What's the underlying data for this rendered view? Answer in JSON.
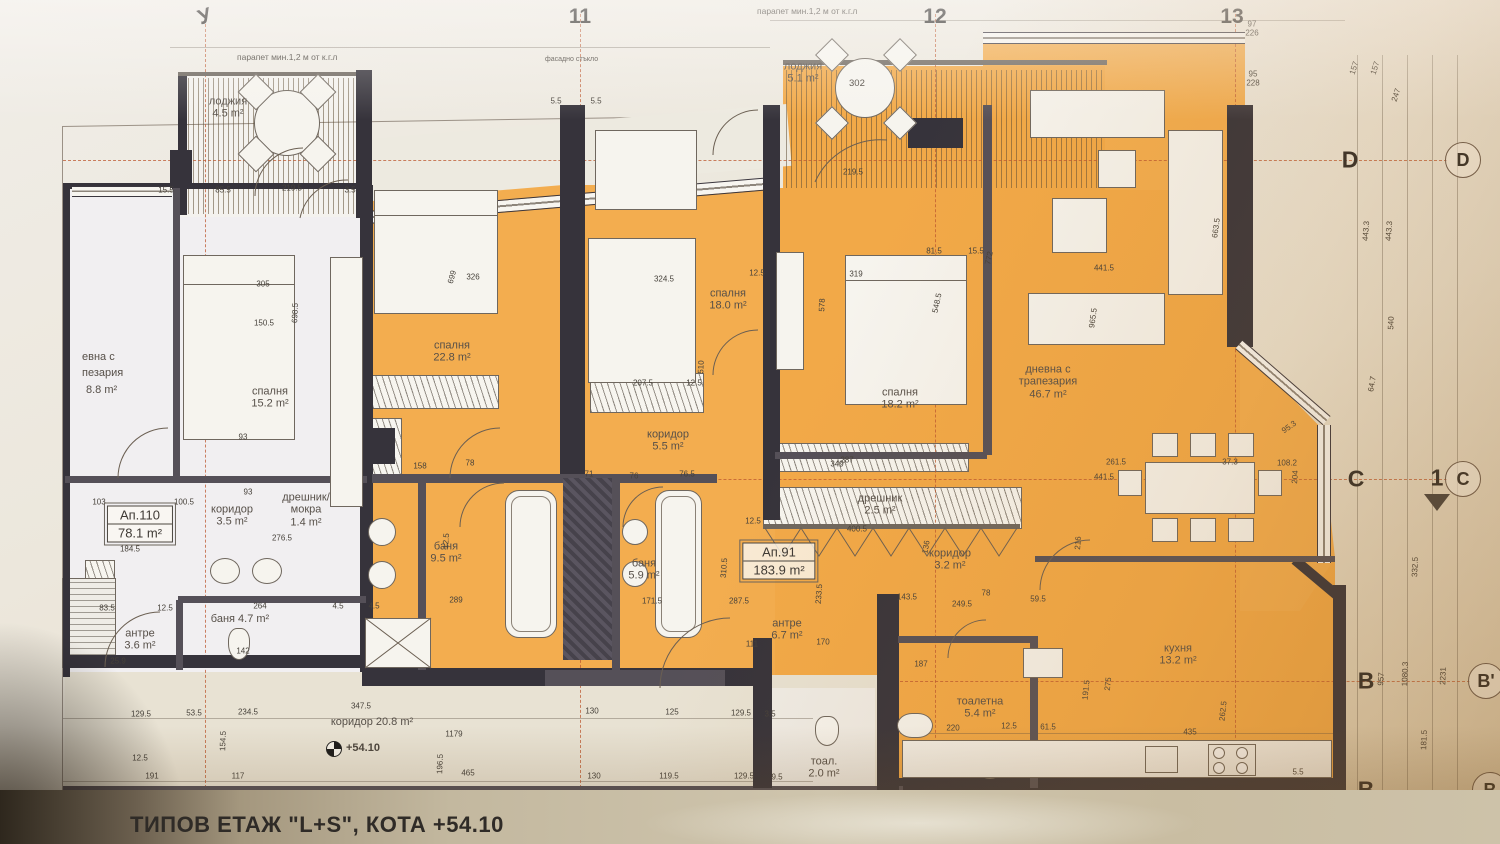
{
  "meta": {
    "title_block": "ТИПОВ ЕТАЖ \"L+S\", КОТА +54.10"
  },
  "annotations": {
    "parapet_left": "парапет мин.1,2 м от к.г.л",
    "parapet_top": "парапет мин.1,2 м от к.г.л",
    "facade_glass": "фасадно стъкло",
    "level_mark": "+54.10",
    "loggia_room_number": "302"
  },
  "apartment_tags": [
    {
      "id": "Ап.110",
      "area": "78.1 m²",
      "x": 140,
      "y": 524
    },
    {
      "id": "Ап.91",
      "area": "183.9 m²",
      "x": 779,
      "y": 561
    }
  ],
  "rooms": [
    {
      "lines": [
        "лоджия",
        "4.5 m²"
      ],
      "x": 228,
      "y": 108
    },
    {
      "lines": [
        "лоджия",
        "5.1 m²"
      ],
      "x": 803,
      "y": 73
    },
    {
      "lines": [
        "спалня",
        "15.2 m²"
      ],
      "x": 270,
      "y": 398
    },
    {
      "lines": [
        "спалня",
        "22.8 m²"
      ],
      "x": 452,
      "y": 352
    },
    {
      "lines": [
        "спалня",
        "18.0 m²"
      ],
      "x": 728,
      "y": 300
    },
    {
      "lines": [
        "спалня",
        "18.2 m²"
      ],
      "x": 900,
      "y": 399
    },
    {
      "lines": [
        "дневна с",
        "трапезария",
        "46.7 m²"
      ],
      "x": 1048,
      "y": 382
    },
    {
      "lines": [
        "коридор",
        "5.5 m²"
      ],
      "x": 668,
      "y": 441
    },
    {
      "lines": [
        "коридор",
        "3.5 m²"
      ],
      "x": 232,
      "y": 516
    },
    {
      "lines": [
        "коридор",
        "3.2 m²"
      ],
      "x": 950,
      "y": 560
    },
    {
      "lines": [
        "баня",
        "9.5 m²"
      ],
      "x": 446,
      "y": 553
    },
    {
      "lines": [
        "баня",
        "5.9 m²"
      ],
      "x": 644,
      "y": 570
    },
    {
      "lines": [
        "баня 4.7 m²"
      ],
      "x": 240,
      "y": 619
    },
    {
      "lines": [
        "антре",
        "3.6 m²"
      ],
      "x": 140,
      "y": 640
    },
    {
      "lines": [
        "антре",
        "6.7 m²"
      ],
      "x": 787,
      "y": 630
    },
    {
      "lines": [
        "дрешник/",
        "мокра",
        "1.4 m²"
      ],
      "x": 306,
      "y": 510
    },
    {
      "lines": [
        "дрешник",
        "2.5 m²"
      ],
      "x": 880,
      "y": 505
    },
    {
      "lines": [
        "тоалетна",
        "5.4 m²"
      ],
      "x": 980,
      "y": 708
    },
    {
      "lines": [
        "тоал.",
        "2.0 m²"
      ],
      "x": 824,
      "y": 768
    },
    {
      "lines": [
        "кухня",
        "13.2 m²"
      ],
      "x": 1178,
      "y": 655
    },
    {
      "lines": [
        "коридор 20.8 m²"
      ],
      "x": 372,
      "y": 722
    }
  ],
  "partial_labels": [
    {
      "t": "евна с",
      "x": 82,
      "y": 357
    },
    {
      "t": "пезария",
      "x": 82,
      "y": 373
    },
    {
      "t": "8.8 m²",
      "x": 86,
      "y": 390
    }
  ],
  "grid": {
    "top": [
      {
        "label": "У",
        "x": 205,
        "r": -18
      },
      {
        "label": "11",
        "x": 580,
        "r": 0
      },
      {
        "label": "12",
        "x": 935,
        "r": 0
      },
      {
        "label": "13",
        "x": 1232,
        "r": 0
      }
    ],
    "right_letters": [
      {
        "label": "D",
        "x": 1350,
        "y": 160
      },
      {
        "label": "C",
        "x": 1356,
        "y": 479
      },
      {
        "label": "B",
        "x": 1366,
        "y": 681
      },
      {
        "label": "B",
        "x": 1366,
        "y": 790
      }
    ],
    "right_bubbles": [
      {
        "label": "D",
        "x": 1463,
        "y": 160
      },
      {
        "label": "C",
        "x": 1463,
        "y": 479
      },
      {
        "label": "B'",
        "x": 1486,
        "y": 681
      },
      {
        "label": "B",
        "x": 1490,
        "y": 790
      }
    ],
    "section_mark": {
      "label": "1",
      "x": 1437,
      "y": 478
    }
  },
  "dims": [
    {
      "t": "15.5",
      "x": 166,
      "y": 190
    },
    {
      "t": "85.5",
      "x": 223,
      "y": 190
    },
    {
      "t": "219.5",
      "x": 292,
      "y": 188
    },
    {
      "t": "3.5",
      "x": 350,
      "y": 190
    },
    {
      "t": "5.5",
      "x": 556,
      "y": 101
    },
    {
      "t": "5.5",
      "x": 596,
      "y": 101
    },
    {
      "t": "219.5",
      "x": 853,
      "y": 172
    },
    {
      "t": "81.5",
      "x": 934,
      "y": 251
    },
    {
      "t": "15.5",
      "x": 976,
      "y": 251
    },
    {
      "t": "305",
      "x": 263,
      "y": 284
    },
    {
      "t": "326",
      "x": 473,
      "y": 277
    },
    {
      "t": "699",
      "x": 452,
      "y": 277,
      "r": -75
    },
    {
      "t": "324.5",
      "x": 664,
      "y": 279
    },
    {
      "t": "12.5",
      "x": 757,
      "y": 273
    },
    {
      "t": "319",
      "x": 856,
      "y": 274
    },
    {
      "t": "548.5",
      "x": 937,
      "y": 303,
      "r": -78
    },
    {
      "t": "772",
      "x": 989,
      "y": 258,
      "r": -78
    },
    {
      "t": "441.5",
      "x": 1104,
      "y": 268
    },
    {
      "t": "441.5",
      "x": 1104,
      "y": 477
    },
    {
      "t": "965.5",
      "x": 1093,
      "y": 318,
      "r": -82
    },
    {
      "t": "663.5",
      "x": 1216,
      "y": 228,
      "r": -82
    },
    {
      "t": "698.5",
      "x": 295,
      "y": 313,
      "r": -88
    },
    {
      "t": "150.5",
      "x": 264,
      "y": 323
    },
    {
      "t": "157",
      "x": 1354,
      "y": 68,
      "r": -72
    },
    {
      "t": "157",
      "x": 1375,
      "y": 68,
      "r": -72
    },
    {
      "t": "247",
      "x": 1396,
      "y": 95,
      "r": -72
    },
    {
      "t": "443.3",
      "x": 1366,
      "y": 231,
      "r": -86
    },
    {
      "t": "443.3",
      "x": 1389,
      "y": 231,
      "r": -86
    },
    {
      "t": "540",
      "x": 1391,
      "y": 323,
      "r": -88
    },
    {
      "t": "64.7",
      "x": 1372,
      "y": 384,
      "r": -80
    },
    {
      "t": "332.5",
      "x": 1415,
      "y": 567,
      "r": -88
    },
    {
      "t": "957",
      "x": 1381,
      "y": 679,
      "r": -86
    },
    {
      "t": "1080.3",
      "x": 1405,
      "y": 674,
      "r": -88
    },
    {
      "t": "2231",
      "x": 1443,
      "y": 676,
      "r": -88
    },
    {
      "t": "181.5",
      "x": 1424,
      "y": 740,
      "r": -88
    },
    {
      "t": "97",
      "x": 1252,
      "y": 24
    },
    {
      "t": "226",
      "x": 1252,
      "y": 33
    },
    {
      "t": "95",
      "x": 1253,
      "y": 74
    },
    {
      "t": "228",
      "x": 1253,
      "y": 83
    },
    {
      "t": "93",
      "x": 243,
      "y": 437
    },
    {
      "t": "93",
      "x": 248,
      "y": 492
    },
    {
      "t": "103",
      "x": 99,
      "y": 502
    },
    {
      "t": "100.5",
      "x": 184,
      "y": 502
    },
    {
      "t": "184.5",
      "x": 130,
      "y": 549
    },
    {
      "t": "276.5",
      "x": 282,
      "y": 538
    },
    {
      "t": "158",
      "x": 420,
      "y": 466
    },
    {
      "t": "78",
      "x": 470,
      "y": 463
    },
    {
      "t": "12.5",
      "x": 446,
      "y": 541,
      "r": -86
    },
    {
      "t": "510",
      "x": 701,
      "y": 367,
      "r": -88
    },
    {
      "t": "12.5",
      "x": 753,
      "y": 521
    },
    {
      "t": "578",
      "x": 822,
      "y": 305,
      "r": -88
    },
    {
      "t": "207.5",
      "x": 643,
      "y": 383
    },
    {
      "t": "12.5",
      "x": 694,
      "y": 383
    },
    {
      "t": "349",
      "x": 837,
      "y": 464
    },
    {
      "t": "71",
      "x": 589,
      "y": 474
    },
    {
      "t": "76",
      "x": 634,
      "y": 476
    },
    {
      "t": "76.5",
      "x": 687,
      "y": 474
    },
    {
      "t": "289",
      "x": 456,
      "y": 600
    },
    {
      "t": "171.5",
      "x": 652,
      "y": 601
    },
    {
      "t": "287.5",
      "x": 739,
      "y": 601
    },
    {
      "t": "143.5",
      "x": 907,
      "y": 597
    },
    {
      "t": "78",
      "x": 986,
      "y": 593
    },
    {
      "t": "249.5",
      "x": 962,
      "y": 604
    },
    {
      "t": "59.5",
      "x": 1038,
      "y": 599
    },
    {
      "t": "136",
      "x": 926,
      "y": 547,
      "r": -80
    },
    {
      "t": "400.5",
      "x": 857,
      "y": 529
    },
    {
      "t": "287",
      "x": 847,
      "y": 460
    },
    {
      "t": "310.5",
      "x": 724,
      "y": 568,
      "r": -86
    },
    {
      "t": "233.5",
      "x": 819,
      "y": 594,
      "r": -86
    },
    {
      "t": "170",
      "x": 823,
      "y": 642
    },
    {
      "t": "111",
      "x": 752,
      "y": 644
    },
    {
      "t": "216",
      "x": 1078,
      "y": 543,
      "r": -86
    },
    {
      "t": "261.5",
      "x": 1116,
      "y": 462
    },
    {
      "t": "37.3",
      "x": 1230,
      "y": 462
    },
    {
      "t": "108.2",
      "x": 1287,
      "y": 463
    },
    {
      "t": "95.3",
      "x": 1289,
      "y": 427,
      "r": -35
    },
    {
      "t": "204",
      "x": 1295,
      "y": 477,
      "r": -86
    },
    {
      "t": "83.5",
      "x": 107,
      "y": 608
    },
    {
      "t": "12.5",
      "x": 165,
      "y": 608
    },
    {
      "t": "264",
      "x": 260,
      "y": 606
    },
    {
      "t": "4.5",
      "x": 338,
      "y": 606
    },
    {
      "t": "4.5",
      "x": 374,
      "y": 606
    },
    {
      "t": "142",
      "x": 243,
      "y": 651
    },
    {
      "t": "25.9",
      "x": 118,
      "y": 661
    },
    {
      "t": "129.5",
      "x": 141,
      "y": 714
    },
    {
      "t": "53.5",
      "x": 194,
      "y": 713
    },
    {
      "t": "234.5",
      "x": 248,
      "y": 712
    },
    {
      "t": "347.5",
      "x": 361,
      "y": 706
    },
    {
      "t": "130",
      "x": 592,
      "y": 711
    },
    {
      "t": "125",
      "x": 672,
      "y": 712
    },
    {
      "t": "129.5",
      "x": 741,
      "y": 713
    },
    {
      "t": "3.5",
      "x": 770,
      "y": 714
    },
    {
      "t": "1179",
      "x": 454,
      "y": 734
    },
    {
      "t": "196.5",
      "x": 440,
      "y": 764,
      "r": -88
    },
    {
      "t": "154.5",
      "x": 223,
      "y": 741,
      "r": -88
    },
    {
      "t": "12.5",
      "x": 140,
      "y": 758
    },
    {
      "t": "191",
      "x": 152,
      "y": 776
    },
    {
      "t": "117",
      "x": 238,
      "y": 776
    },
    {
      "t": "465",
      "x": 468,
      "y": 773
    },
    {
      "t": "130",
      "x": 594,
      "y": 776
    },
    {
      "t": "119.5",
      "x": 669,
      "y": 776
    },
    {
      "t": "129.5",
      "x": 744,
      "y": 776
    },
    {
      "t": "9.5",
      "x": 777,
      "y": 777
    },
    {
      "t": "220",
      "x": 953,
      "y": 728
    },
    {
      "t": "12.5",
      "x": 1009,
      "y": 726
    },
    {
      "t": "61.5",
      "x": 1048,
      "y": 727
    },
    {
      "t": "191.5",
      "x": 1086,
      "y": 690,
      "r": -84
    },
    {
      "t": "275",
      "x": 1108,
      "y": 684,
      "r": -84
    },
    {
      "t": "435",
      "x": 1190,
      "y": 732
    },
    {
      "t": "262.5",
      "x": 1223,
      "y": 711,
      "r": -84
    },
    {
      "t": "187",
      "x": 921,
      "y": 664
    },
    {
      "t": "5.5",
      "x": 1298,
      "y": 772
    }
  ]
}
